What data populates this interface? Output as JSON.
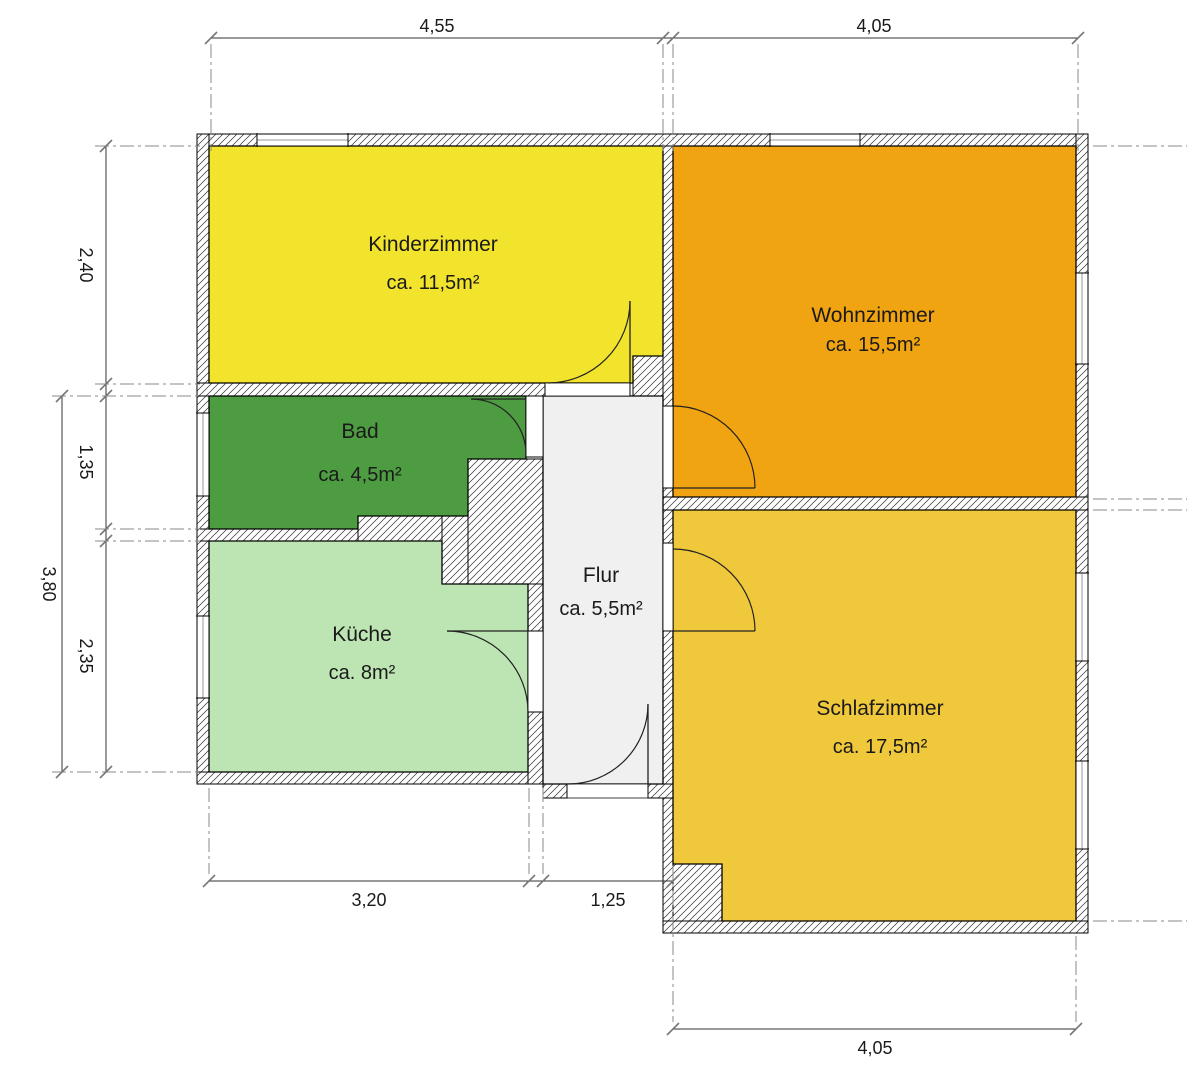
{
  "plan": {
    "canvas": {
      "width": 1187,
      "height": 1048,
      "background": "#ffffff"
    },
    "colors": {
      "wall_hatch": "#3a3a3a",
      "outline": "#000000",
      "dim_line": "#333333",
      "tick": "#777777",
      "extension_line": "#8a8a8a",
      "window_center": "#999999",
      "door_line": "#222222"
    },
    "rooms": [
      {
        "id": "kinderzimmer",
        "name": "Kinderzimmer",
        "area": "ca. 11,5m²",
        "color": "#F2E42C",
        "points": "169,130 623,130 623,340 593,340 593,367 169,367",
        "label": {
          "x": 393,
          "y": 235
        },
        "area_label": {
          "x": 393,
          "y": 273
        }
      },
      {
        "id": "wohnzimmer",
        "name": "Wohnzimmer",
        "area": "ca. 15,5m²",
        "color": "#F1A412",
        "points": "633,130 1036,130 1036,481 633,481",
        "label": {
          "x": 833,
          "y": 306
        },
        "area_label": {
          "x": 833,
          "y": 335
        }
      },
      {
        "id": "bad",
        "name": "Bad",
        "area": "ca. 4,5m²",
        "color": "#4E9C41",
        "points": "169,380 486,380 486,443 428,443 428,500 318,500 318,513 169,513",
        "label": {
          "x": 320,
          "y": 422
        },
        "area_label": {
          "x": 320,
          "y": 465
        }
      },
      {
        "id": "kueche",
        "name": "Küche",
        "area": "ca. 8m²",
        "color": "#BDE5B3",
        "points": "169,525 402,525 402,568 488,568 488,756 169,756",
        "label": {
          "x": 322,
          "y": 625
        },
        "area_label": {
          "x": 322,
          "y": 663
        }
      },
      {
        "id": "flur",
        "name": "Flur",
        "area": "ca. 5,5m²",
        "color": "#F0F0F0",
        "points": "503,380 623,380 623,768 503,768",
        "label": {
          "x": 561,
          "y": 566
        },
        "area_label": {
          "x": 561,
          "y": 599
        }
      },
      {
        "id": "schlafzimmer",
        "name": "Schlafzimmer",
        "area": "ca. 17,5m²",
        "color": "#F0C83C",
        "points": "633,494 1036,494 1036,905 682,905 682,848 633,848",
        "label": {
          "x": 840,
          "y": 699
        },
        "area_label": {
          "x": 840,
          "y": 737
        }
      }
    ],
    "walls": [
      {
        "x": 157,
        "y": 118,
        "w": 891,
        "h": 12
      },
      {
        "x": 157,
        "y": 118,
        "w": 12,
        "h": 650
      },
      {
        "x": 1036,
        "y": 118,
        "w": 12,
        "h": 799
      },
      {
        "x": 157,
        "y": 756,
        "w": 346,
        "h": 12
      },
      {
        "x": 157,
        "y": 367,
        "w": 348,
        "h": 13
      },
      {
        "x": 593,
        "y": 340,
        "w": 40,
        "h": 40
      },
      {
        "x": 623,
        "y": 130,
        "w": 10,
        "h": 260
      },
      {
        "x": 623,
        "y": 472,
        "w": 10,
        "h": 55
      },
      {
        "x": 623,
        "y": 615,
        "w": 10,
        "h": 302
      },
      {
        "x": 157,
        "y": 513,
        "w": 161,
        "h": 12
      },
      {
        "x": 318,
        "y": 500,
        "w": 84,
        "h": 25
      },
      {
        "x": 402,
        "y": 500,
        "w": 26,
        "h": 68
      },
      {
        "x": 428,
        "y": 443,
        "w": 75,
        "h": 125
      },
      {
        "x": 488,
        "y": 568,
        "w": 15,
        "h": 47
      },
      {
        "x": 488,
        "y": 696,
        "w": 15,
        "h": 72
      },
      {
        "x": 623,
        "y": 481,
        "w": 425,
        "h": 13
      },
      {
        "x": 623,
        "y": 905,
        "w": 425,
        "h": 12
      },
      {
        "x": 633,
        "y": 848,
        "w": 49,
        "h": 57
      },
      {
        "x": 503,
        "y": 768,
        "w": 24,
        "h": 14
      },
      {
        "x": 608,
        "y": 768,
        "w": 25,
        "h": 14
      }
    ],
    "windows": [
      {
        "x": 217,
        "y": 118,
        "w": 91,
        "h": 12,
        "orient": "h"
      },
      {
        "x": 730,
        "y": 118,
        "w": 90,
        "h": 12,
        "orient": "h"
      },
      {
        "x": 157,
        "y": 397,
        "w": 12,
        "h": 83,
        "orient": "v"
      },
      {
        "x": 157,
        "y": 600,
        "w": 12,
        "h": 82,
        "orient": "v"
      },
      {
        "x": 1036,
        "y": 257,
        "w": 12,
        "h": 91,
        "orient": "v"
      },
      {
        "x": 1036,
        "y": 557,
        "w": 12,
        "h": 88,
        "orient": "v"
      },
      {
        "x": 1036,
        "y": 745,
        "w": 12,
        "h": 88,
        "orient": "v"
      }
    ],
    "door_openings": [
      {
        "x": 505,
        "y": 367,
        "w": 85,
        "h": 13,
        "orient": "h"
      },
      {
        "x": 486,
        "y": 380,
        "w": 17,
        "h": 61,
        "orient": "v"
      },
      {
        "x": 488,
        "y": 615,
        "w": 15,
        "h": 81,
        "orient": "v"
      },
      {
        "x": 623,
        "y": 390,
        "w": 10,
        "h": 82,
        "orient": "v"
      },
      {
        "x": 623,
        "y": 527,
        "w": 10,
        "h": 88,
        "orient": "v"
      },
      {
        "x": 527,
        "y": 768,
        "w": 81,
        "h": 14,
        "orient": "h"
      }
    ],
    "doors": [
      {
        "name": "kinderzimmer-door",
        "leaf": [
          590,
          285,
          590,
          367
        ],
        "arc": "M508,367 A82,82 0 0 0 590,285"
      },
      {
        "name": "bad-door",
        "leaf": [
          431,
          383,
          486,
          383
        ],
        "arc": "M431,383 A55,55 0 0 1 486,438"
      },
      {
        "name": "kueche-door",
        "leaf": [
          407,
          615,
          488,
          615
        ],
        "arc": "M407,615 A81,81 0 0 1 488,696"
      },
      {
        "name": "wohnzimmer-door",
        "leaf": [
          633,
          472,
          715,
          472
        ],
        "arc": "M715,472 A82,82 0 0 0 633,390"
      },
      {
        "name": "schlafzimmer-door",
        "leaf": [
          633,
          615,
          715,
          615
        ],
        "arc": "M715,615 A82,82 0 0 0 633,533"
      },
      {
        "name": "entrance-door",
        "leaf": [
          608,
          688,
          608,
          768
        ],
        "arc": "M528,768 A80,80 0 0 0 608,688"
      }
    ],
    "dimensions": [
      {
        "orient": "h",
        "x1": 171,
        "x2": 1038,
        "y": 22,
        "ticks": [
          171,
          623,
          633,
          1038
        ],
        "labels": [
          {
            "text": "4,55",
            "x": 397,
            "y": 16
          },
          {
            "text": "4,05",
            "x": 834,
            "y": 16
          }
        ]
      },
      {
        "orient": "h",
        "x1": 169,
        "x2": 633,
        "y": 865,
        "ticks": [
          169,
          489,
          503,
          633
        ],
        "labels": [
          {
            "text": "3,20",
            "x": 329,
            "y": 890
          },
          {
            "text": "1,25",
            "x": 568,
            "y": 890
          }
        ]
      },
      {
        "orient": "h",
        "x1": 633,
        "x2": 1036,
        "y": 1013,
        "ticks": [
          633,
          1036
        ],
        "labels": [
          {
            "text": "4,05",
            "x": 835,
            "y": 1038
          }
        ]
      },
      {
        "orient": "v",
        "x": 66,
        "y1": 130,
        "y2": 756,
        "ticks": [
          130,
          368,
          380,
          513,
          525,
          756
        ],
        "labels": [
          {
            "text": "2,40",
            "x": 40,
            "y": 249
          },
          {
            "text": "1,35",
            "x": 40,
            "y": 446
          },
          {
            "text": "2,35",
            "x": 40,
            "y": 640
          }
        ]
      },
      {
        "orient": "v",
        "x": 22,
        "y1": 380,
        "y2": 756,
        "ticks": [
          380,
          756
        ],
        "labels": [
          {
            "text": "3,80",
            "x": 3,
            "y": 568
          }
        ]
      },
      {
        "orient": "v",
        "x": 1160,
        "y1": 130,
        "y2": 483,
        "ticks": [
          130,
          483
        ],
        "labels": [
          {
            "text": "3,55",
            "x": 1166,
            "y": 306
          }
        ]
      },
      {
        "orient": "v",
        "x": 1160,
        "y1": 494,
        "y2": 905,
        "ticks": [
          494,
          905
        ],
        "labels": [
          {
            "text": "4,15",
            "x": 1166,
            "y": 700
          }
        ]
      }
    ],
    "extension_lines": [
      [
        171,
        28,
        171,
        135
      ],
      [
        623,
        28,
        623,
        135
      ],
      [
        633,
        28,
        633,
        135
      ],
      [
        1038,
        28,
        1038,
        135
      ],
      [
        55,
        130,
        160,
        130
      ],
      [
        55,
        368,
        160,
        368
      ],
      [
        12,
        380,
        160,
        380
      ],
      [
        55,
        513,
        160,
        513
      ],
      [
        55,
        525,
        160,
        525
      ],
      [
        12,
        756,
        160,
        756
      ],
      [
        169,
        772,
        169,
        858
      ],
      [
        489,
        772,
        489,
        858
      ],
      [
        503,
        772,
        503,
        858
      ],
      [
        633,
        850,
        633,
        1006
      ],
      [
        1036,
        920,
        1036,
        1006
      ],
      [
        1053,
        130,
        1170,
        130
      ],
      [
        1053,
        483,
        1170,
        483
      ],
      [
        1053,
        494,
        1170,
        494
      ],
      [
        1053,
        905,
        1170,
        905
      ]
    ]
  }
}
